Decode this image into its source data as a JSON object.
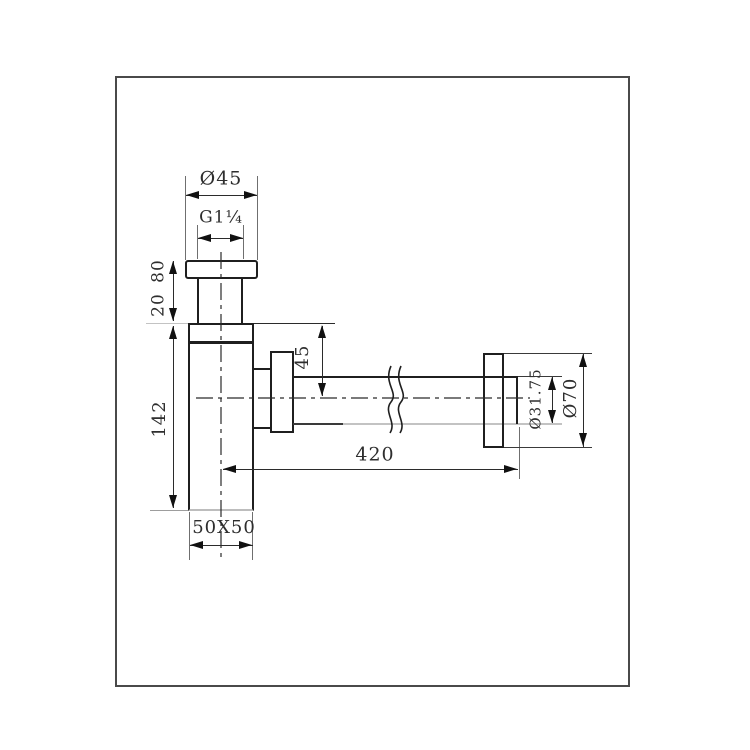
{
  "drawing": {
    "colors": {
      "line": "#1f1f1f",
      "dimension_line": "#2b2b2b",
      "light_line": "#c3c3c3",
      "frame_border": "#4a4a4a",
      "background": "#ffffff"
    },
    "labels": {
      "top_diameter": "Ø45",
      "thread": "G1¼",
      "height_80": "80",
      "height_20": "20",
      "body_height": "142",
      "outlet_drop": "45",
      "pipe_length": "420",
      "pipe_diameter": "Ø31.75",
      "flange_diameter": "Ø70",
      "body_section": "50X50"
    }
  }
}
